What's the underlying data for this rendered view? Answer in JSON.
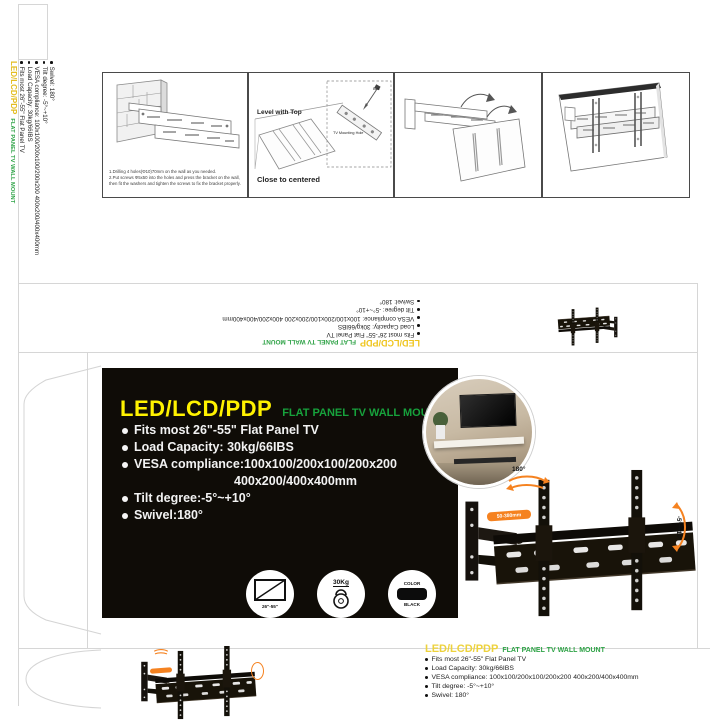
{
  "side_strip": {
    "brand": "LED/LCD/PDP",
    "tagline": "FLAT PANEL TV WALL MOUNT",
    "specs": [
      "Fits most 26\"-55\" Flat Panel TV",
      "Load Capacity: 30kg/66IBS",
      "VESA compliance: 100x100/200x100/200x200 400x200/400x400mm",
      "Tilt degree: -5°~+10°",
      "Swivel: 180°"
    ]
  },
  "instructions": {
    "step1": {
      "captions": [
        "1.Drilling 4 holes(Φ10)70mm on the wall as you needed.",
        "2.Put screws Φ5x50 into the holes and press the bracket on the wall,",
        "then fit the washers and tighten the screws to fix the bracket properly."
      ]
    },
    "step2": {
      "label_level": "Level with Top",
      "label_center": "Close to centered",
      "label_hole": "TV Mounting Hole",
      "label_bolt": "Bolt"
    }
  },
  "inverted_strip": {
    "brand": "LED/LCD/PDP",
    "tagline": "FLAT PANEL TV WALL MOUNT",
    "specs": [
      "Fits most 26\"-55\" Flat Panel TV",
      "Load Capacity: 30kg/66IBS",
      "VESA compliance: 100x100/200x100/200x200 400x200/400x400mm",
      "Tilt degree: -5°~+10°",
      "Swivel: 180°"
    ]
  },
  "front_panel": {
    "brand": "LED/LCD/PDP",
    "tagline": "FLAT PANEL TV WALL MOUNT",
    "specs": [
      "Fits most 26\"-55\" Flat Panel TV",
      "Load Capacity: 30kg/66IBS",
      "VESA compliance:100x100/200x100/200x200",
      "400x200/400x400mm",
      "Tilt degree:-5°~+10°",
      "Swivel:180°"
    ],
    "badges": {
      "screen_range": "26\"-55\"",
      "weight": "30Kg",
      "color_label": "COLOR",
      "color_value": "BLACK"
    }
  },
  "product": {
    "swivel": "180°",
    "extension": "50-380mm",
    "tilt": "-5°~+10°"
  },
  "bottom_panel": {
    "brand": "LED/LCD/PDP",
    "tagline": "FLAT PANEL TV WALL MOUNT",
    "specs": [
      "Fits most 26\"-55\" Flat Panel TV",
      "Load Capacity: 30kg/66IBS",
      "VESA compliance: 100x100/200x100/200x200 400x200/400x400mm",
      "Tilt degree: -5°~+10°",
      "Swivel: 180°"
    ]
  },
  "colors": {
    "brand_yellow": "#FFF200",
    "brand_yellow_on_white": "#EDCB2A",
    "green_on_black": "#17A23C",
    "green_on_white": "#2FA347",
    "panel_black": "#0F0C07",
    "accent_orange": "#F58220"
  }
}
